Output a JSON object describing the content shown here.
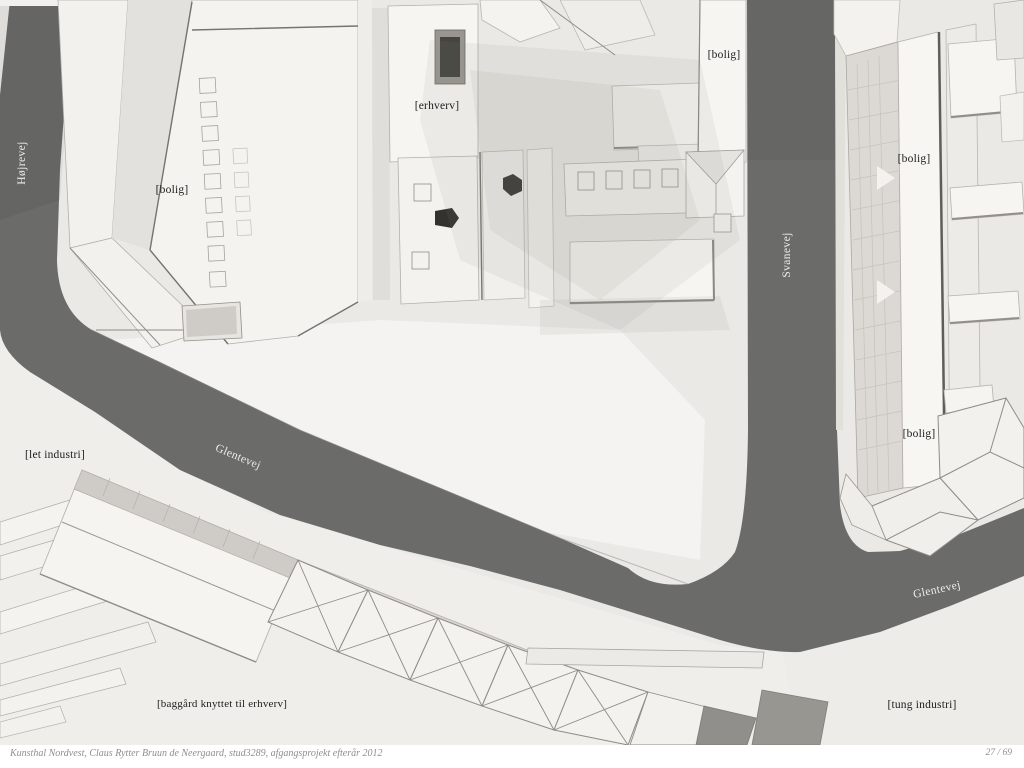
{
  "document": {
    "kind": "architecture presentation page with aerial photo of a cardboard site model"
  },
  "labels": {
    "hojrevej": "Højrevej",
    "svanevej": "Svanevej",
    "glentevej_west": "Glentevej",
    "glentevej_east": "Glentevej",
    "bolig_nw": "[bolig]",
    "bolig_n": "[bolig]",
    "bolig_ne": "[bolig]",
    "bolig_se": "[bolig]",
    "erhverv": "[erhverv]",
    "let_industri": "[let industri]",
    "baggard": "[baggård knyttet til erhverv]",
    "tung_industri": "[tung industri]"
  },
  "footer": {
    "caption": "Kunsthal Nordvest, Claus Rytter Bruun de Neergaard, stud3289, afgangsprojekt efterår 2012",
    "page_number": "27 / 69"
  },
  "colors": {
    "road": "#6b6b69",
    "model_white": "#f5f4f1",
    "ground": "#ebe9e6",
    "label_black": "#1c1c1b",
    "label_white": "#efeeea",
    "footer_text": "#8e8e8c"
  }
}
